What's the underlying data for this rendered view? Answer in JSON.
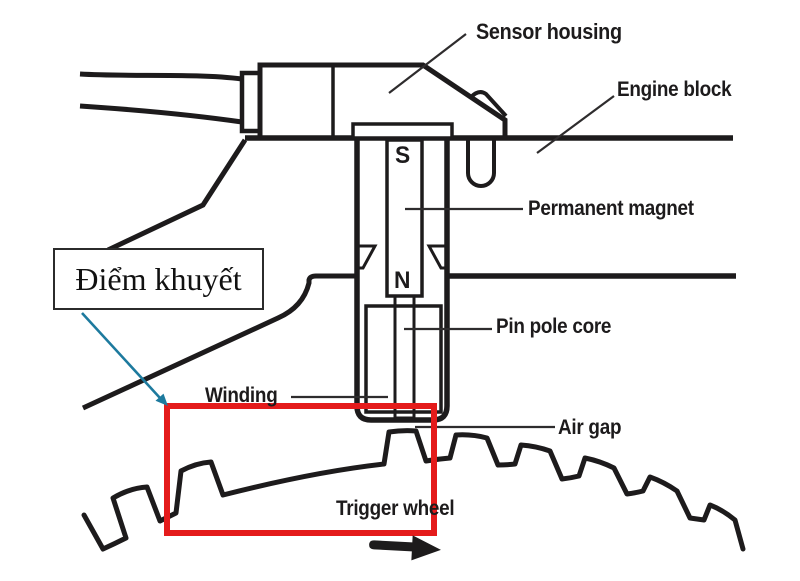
{
  "diagram": {
    "labels": {
      "sensor_housing": "Sensor housing",
      "engine_block": "Engine block",
      "permanent_magnet": "Permanent magnet",
      "pin_pole_core": "Pin pole core",
      "winding": "Winding",
      "air_gap": "Air gap",
      "trigger_wheel": "Trigger wheel"
    },
    "callout": {
      "text": "Điểm khuyết"
    },
    "magnet_poles": {
      "south": "S",
      "north": "N"
    },
    "colors": {
      "line_black": "#1d1b1c",
      "leader_gray": "#2e2c2d",
      "highlight_red": "#e41b1b",
      "callout_arrow_teal": "#1d7a9e",
      "background": "#ffffff"
    }
  }
}
